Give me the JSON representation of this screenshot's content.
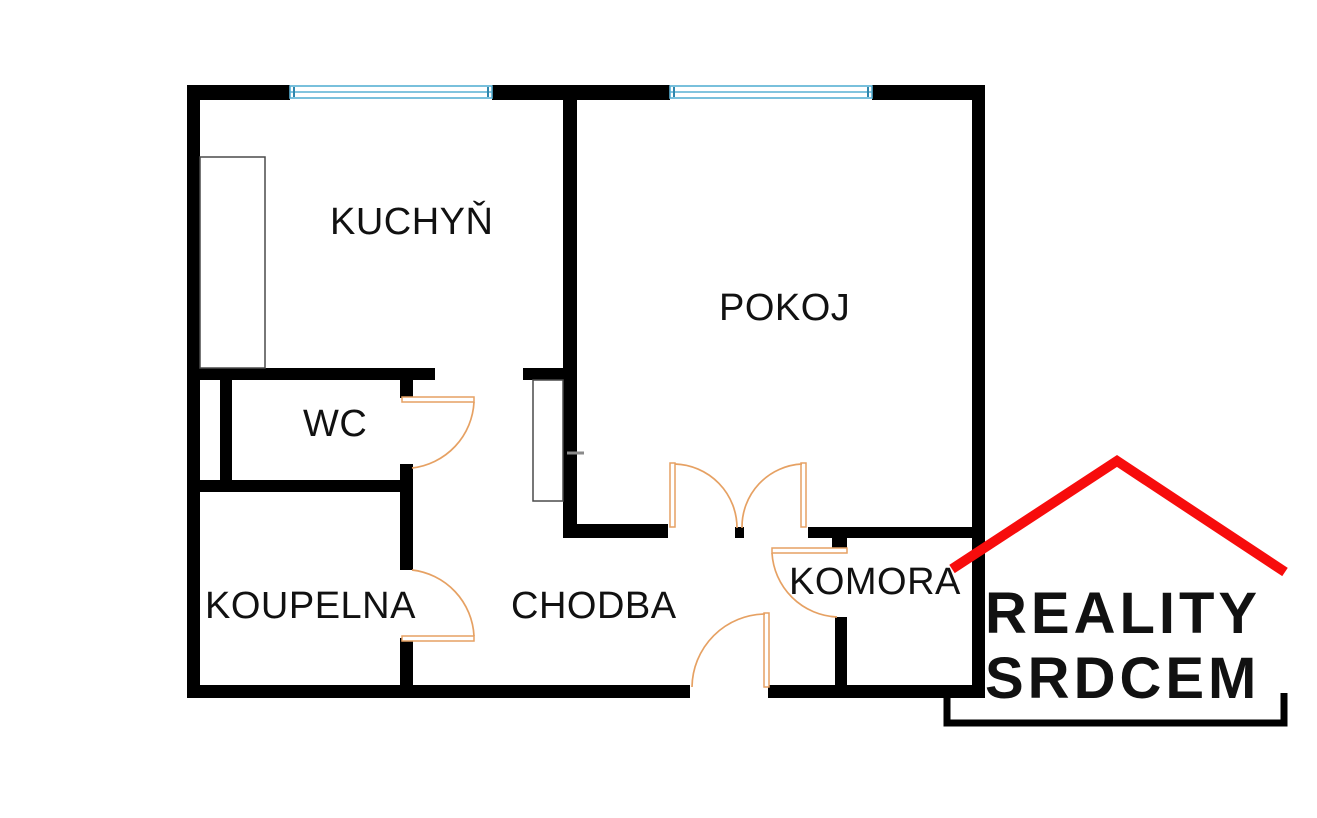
{
  "rooms": [
    {
      "id": "kuchyn",
      "label": "KUCHYŇ"
    },
    {
      "id": "pokoj",
      "label": "POKOJ"
    },
    {
      "id": "wc",
      "label": "WC"
    },
    {
      "id": "koupelna",
      "label": "KOUPELNA"
    },
    {
      "id": "chodba",
      "label": "CHODBA"
    },
    {
      "id": "komora",
      "label": "KOMORA"
    }
  ],
  "logo": {
    "line1": "REALITY",
    "line2": "SRDCEM"
  },
  "colors": {
    "wall": "#000000",
    "door": "#e6a163",
    "window": "#58b0d4",
    "window-tick": "#2e86ad",
    "roof": "#f70c0c",
    "label-text": "#111111",
    "logo-text": "#111111",
    "fixture": "#4a4a4a",
    "tick": "#8a8a8a",
    "bg": "#ffffff"
  }
}
